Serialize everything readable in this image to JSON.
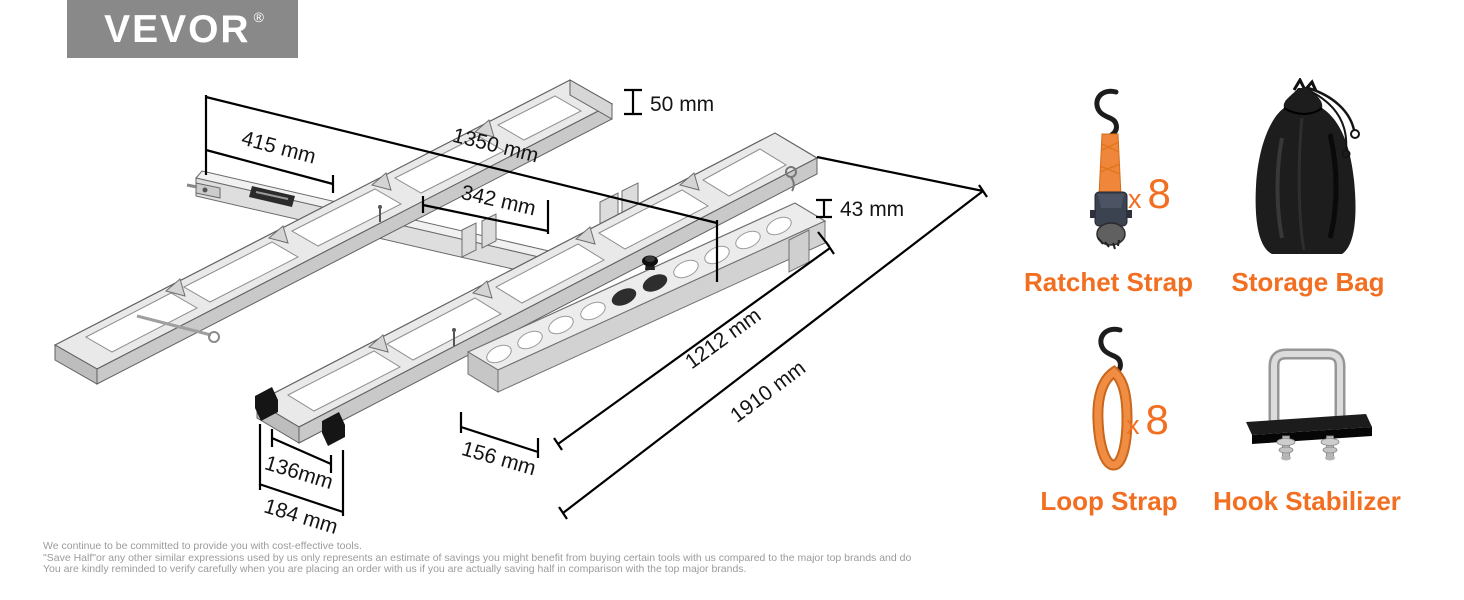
{
  "brand": {
    "name": "VEVOR",
    "reg": "®"
  },
  "diagram": {
    "dimensions": {
      "d415": "415 mm",
      "d1350": "1350 mm",
      "d50": "50 mm",
      "d342": "342 mm",
      "d43": "43 mm",
      "d1212": "1212 mm",
      "d1910": "1910 mm",
      "d156": "156 mm",
      "d136": "136mm",
      "d184": "184 mm"
    }
  },
  "accessories": {
    "ratchet": {
      "label": "Ratchet Strap",
      "qty_x": "x",
      "qty_n": "8"
    },
    "bag": {
      "label": "Storage Bag"
    },
    "loop": {
      "label": "Loop Strap",
      "qty_x": "x",
      "qty_n": "8"
    },
    "hook": {
      "label": "Hook Stabilizer"
    }
  },
  "footer": {
    "line1": "We continue to be committed to provide you with cost-effective tools.",
    "line2": "\"Save Half\"or any other similar expressions used by us only represents an estimate of savings you might benefit from buying certain tools with us compared to the major top brands and do",
    "line3": "You are kindly reminded to verify carefully when you are placing an order with us if you are actually saving half in comparison with the top major brands."
  },
  "colors": {
    "accent": "#f26f21",
    "logo_bg": "#898989"
  }
}
